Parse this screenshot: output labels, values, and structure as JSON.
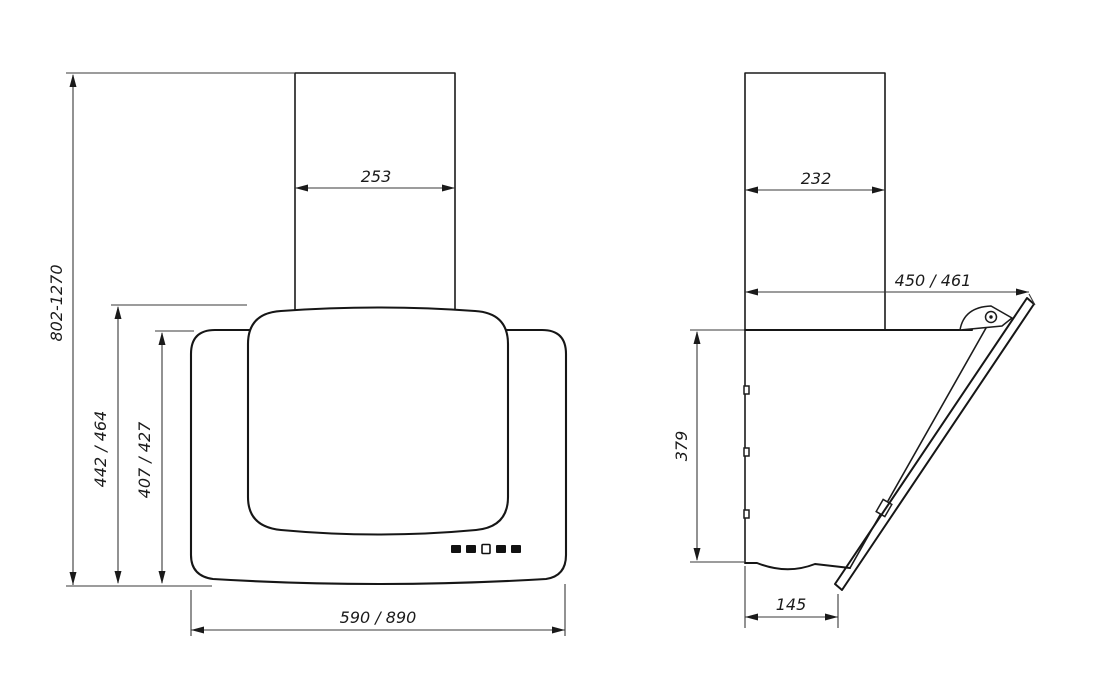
{
  "drawing": {
    "title": "cooker-hood-dimension-drawing",
    "front_view": {
      "chimney_width": "253",
      "mounting_height": "802-1270",
      "height_total": "442 / 464",
      "height_body": "407 / 427",
      "width": "590 / 890"
    },
    "side_view": {
      "chimney_depth": "232",
      "total_depth": "450 / 461",
      "body_height": "379",
      "bottom_depth": "145"
    },
    "colors": {
      "object_line": "#161616",
      "dimension_line": "#3a3a3a",
      "text": "#1b1b1b",
      "background": "#ffffff"
    }
  }
}
